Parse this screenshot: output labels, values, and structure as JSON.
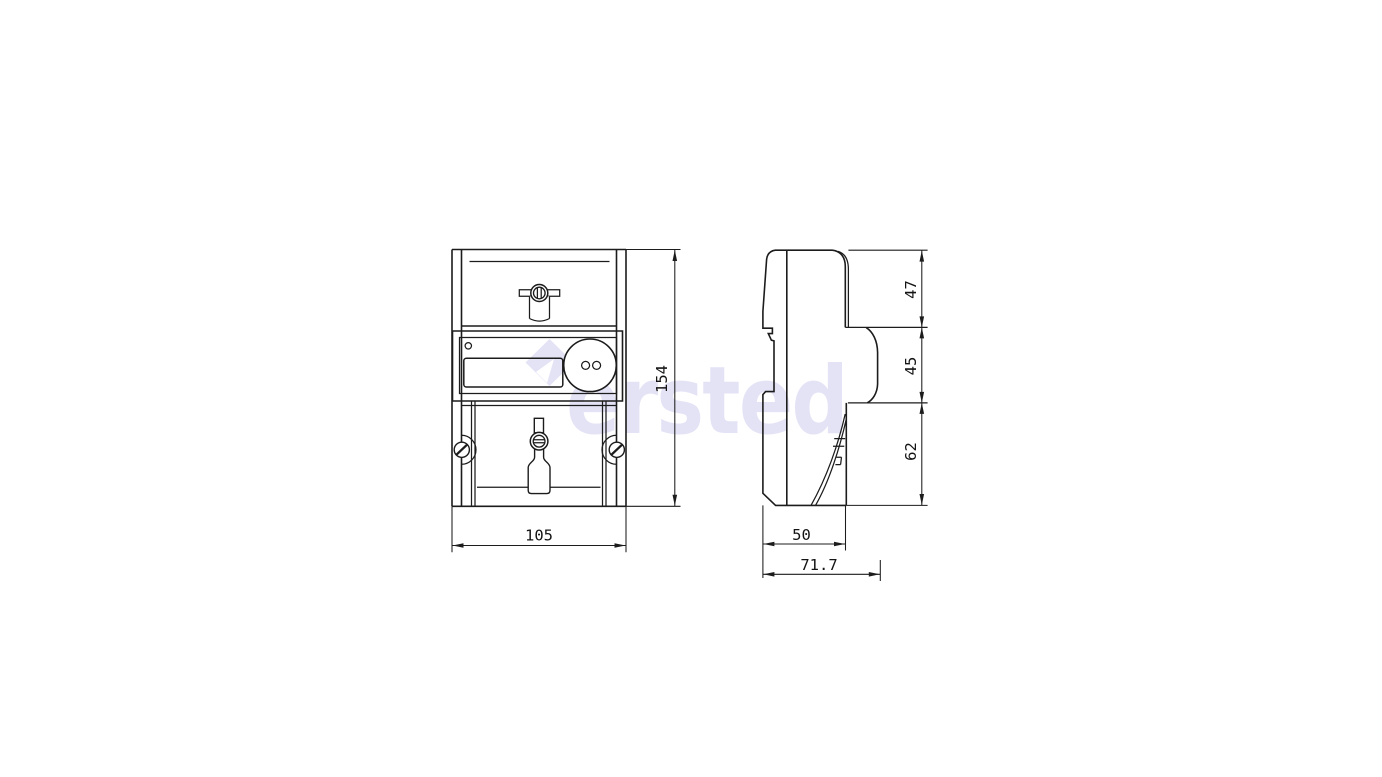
{
  "watermark": {
    "text": "ersted",
    "color": "#e4e3f6"
  },
  "front_view": {
    "name": "front view",
    "dims": {
      "width": "105",
      "height": "154"
    }
  },
  "side_view": {
    "name": "side view",
    "dims": {
      "top_section_height": "47",
      "middle_section_height": "45",
      "bottom_section_height": "62",
      "mounting_depth": "50",
      "overall_depth": "71.7"
    }
  },
  "style": {
    "line_color": "#1c1c1c",
    "background": "#ffffff"
  }
}
